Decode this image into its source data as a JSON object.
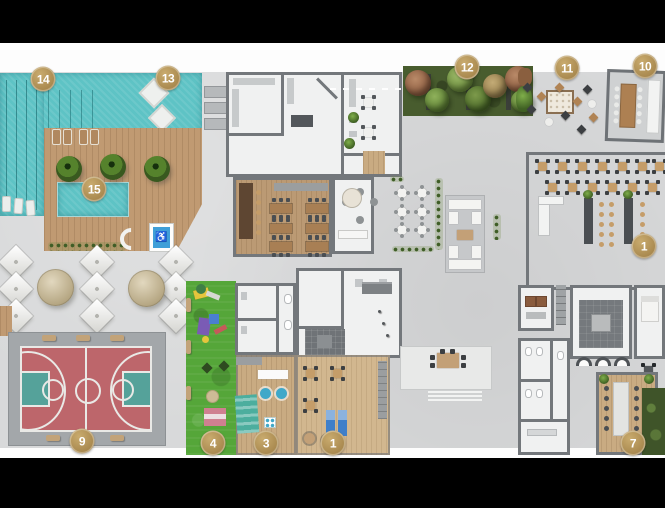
{
  "floorplan": {
    "markers": [
      {
        "label": "14",
        "x": 43,
        "y": 79
      },
      {
        "label": "13",
        "x": 168,
        "y": 78
      },
      {
        "label": "15",
        "x": 94,
        "y": 189
      },
      {
        "label": "12",
        "x": 467,
        "y": 67
      },
      {
        "label": "11",
        "x": 567,
        "y": 68
      },
      {
        "label": "10",
        "x": 645,
        "y": 66
      },
      {
        "label": "1",
        "x": 644,
        "y": 246
      },
      {
        "label": "9",
        "x": 82,
        "y": 441
      },
      {
        "label": "4",
        "x": 213,
        "y": 443
      },
      {
        "label": "3",
        "x": 266,
        "y": 443
      },
      {
        "label": "1",
        "x": 333,
        "y": 443
      },
      {
        "label": "7",
        "x": 633,
        "y": 443
      }
    ],
    "accessibility_symbol": "♿",
    "palette": {
      "black-bar": "#000000",
      "concrete": "#d8d9da",
      "pool": "#5ec3c5",
      "deck": "#c09a72",
      "wood": "#c9ab82",
      "grass": "#55a639",
      "court-red": "#bd666b",
      "court-teal": "#55a29a",
      "pad": "#a3a7aa",
      "wall": "#73777b",
      "white-room": "#f0f1f1",
      "hedge": "#5d8038",
      "marker-gold": "#b2935a"
    }
  }
}
